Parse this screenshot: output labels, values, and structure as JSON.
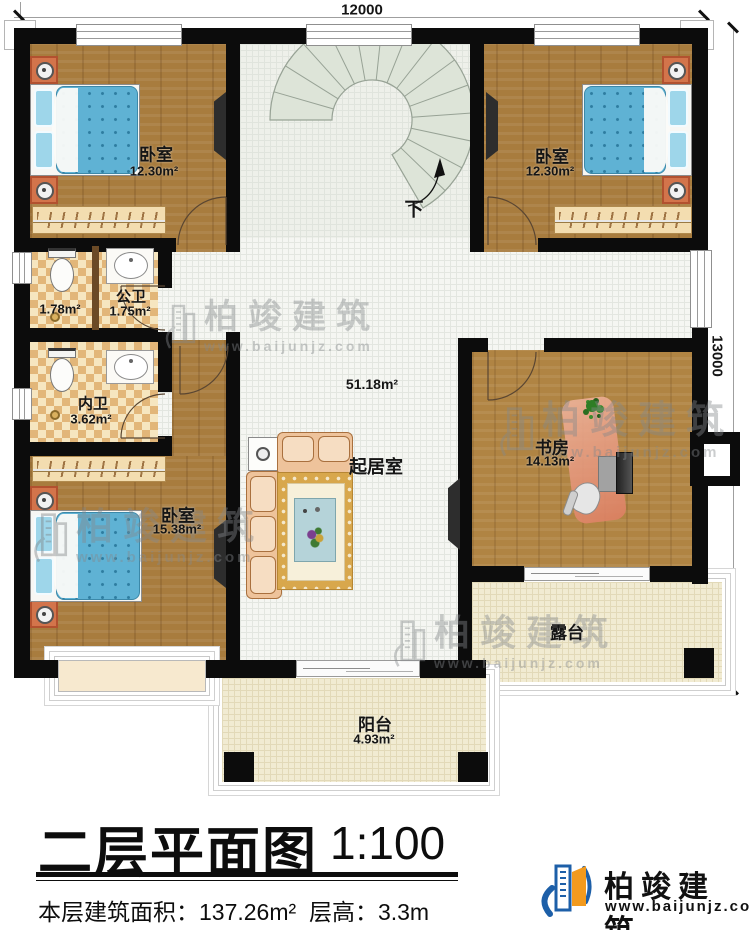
{
  "dimensions": {
    "top": "12000",
    "right": "13000"
  },
  "stairs": {
    "down_label": "下"
  },
  "rooms": {
    "bedroom_tl": {
      "name": "卧室",
      "area": "12.30m²"
    },
    "bedroom_tr": {
      "name": "卧室",
      "area": "12.30m²"
    },
    "bath_sub": {
      "area": "1.78m²"
    },
    "bath_public": {
      "name": "公卫",
      "area": "1.75m²"
    },
    "bath_private": {
      "name": "内卫",
      "area": "3.62m²"
    },
    "bedroom_bl": {
      "name": "卧室",
      "area": "15.38m²"
    },
    "living": {
      "name": "起居室",
      "area": "51.18m²"
    },
    "study": {
      "name": "书房",
      "area": "14.13m²"
    },
    "terrace": {
      "name": "露台"
    },
    "balcony": {
      "name": "阳台",
      "area": "4.93m²"
    }
  },
  "title_block": {
    "title": "二层平面图",
    "scale": "1:100",
    "area_label": "本层建筑面积：",
    "area_value": "137.26m²",
    "height_label": "层高：",
    "height_value": "3.3m"
  },
  "brand": {
    "name": "柏竣建筑",
    "url": "www.baijunjz.com"
  },
  "colors": {
    "accent_blue": "#1d5fa8",
    "accent_orange": "#f29a1e",
    "wall": "#0c0c0c"
  }
}
